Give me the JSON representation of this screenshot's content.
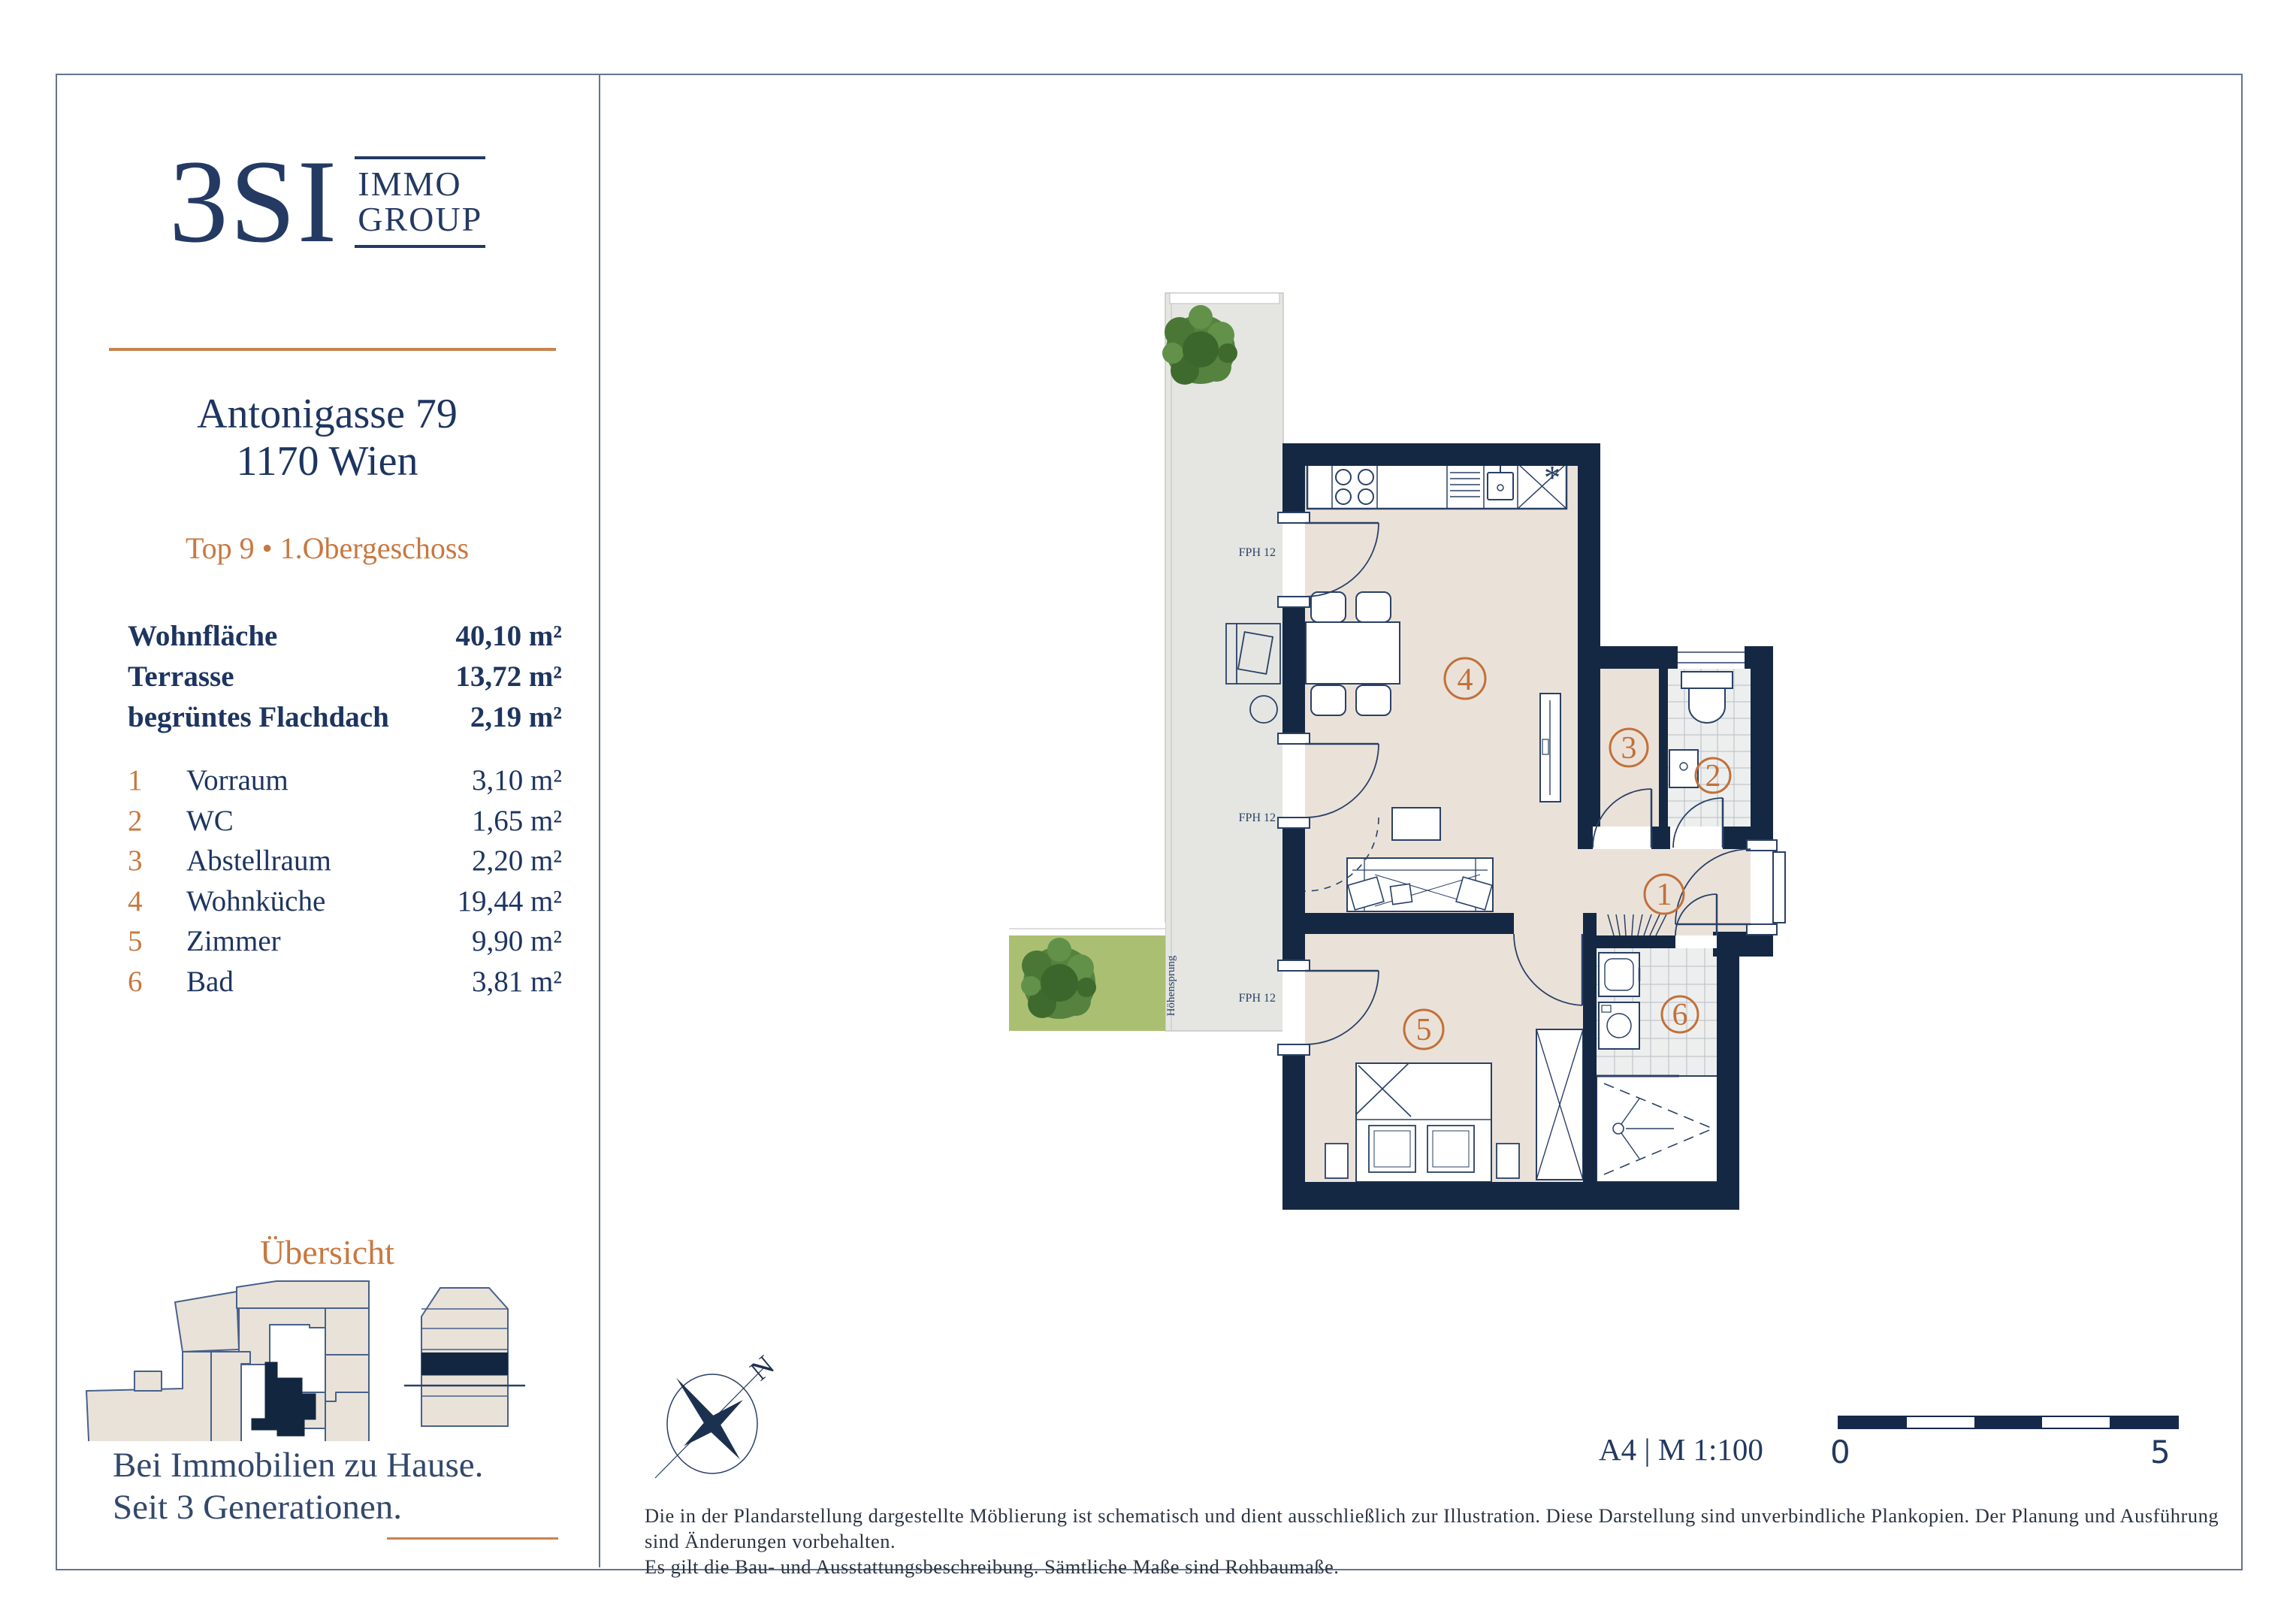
{
  "brand": {
    "logo_text": "3SI",
    "logo_sub_line1": "IMMO",
    "logo_sub_line2": "GROUP"
  },
  "sidebar": {
    "address_line1": "Antonigasse 79",
    "address_line2": "1170 Wien",
    "unit_line": "Top 9 • 1.Obergeschoss",
    "summary": [
      {
        "label": "Wohnfläche",
        "value": "40,10 m²"
      },
      {
        "label": "Terrasse",
        "value": "13,72 m²"
      },
      {
        "label": "begrüntes Flachdach",
        "value": "2,19 m²"
      }
    ],
    "rooms": [
      {
        "num": "1",
        "name": "Vorraum",
        "value": "3,10 m²"
      },
      {
        "num": "2",
        "name": "WC",
        "value": "1,65 m²"
      },
      {
        "num": "3",
        "name": "Abstellraum",
        "value": "2,20 m²"
      },
      {
        "num": "4",
        "name": "Wohnküche",
        "value": "19,44 m²"
      },
      {
        "num": "5",
        "name": "Zimmer",
        "value": "9,90 m²"
      },
      {
        "num": "6",
        "name": "Bad",
        "value": "3,81 m²"
      }
    ],
    "overview_title": "Übersicht",
    "tagline_line1": "Bei Immobilien zu Hause.",
    "tagline_line2": "Seit 3 Generationen."
  },
  "plan": {
    "room_numbers": [
      "1",
      "2",
      "3",
      "4",
      "5",
      "6"
    ],
    "fph_label": "FPH 12",
    "hoehensprung_label": "Höhensprung",
    "freezer_symbol": "*"
  },
  "compass": {
    "north_label": "N"
  },
  "footer": {
    "format_scale": "A4 | M 1:100",
    "scale_zero": "0",
    "scale_five": "5",
    "disclaimer_line1": "Die in der Plandarstellung dargestellte Möblierung ist schematisch und dient ausschließlich zur Illustration. Diese Darstellung sind unverbindliche Plankopien. Der Planung und Ausführung sind Änderungen vorbehalten.",
    "disclaimer_line2": "Es gilt die Bau- und Ausstattungsbeschreibung. Sämtliche Maße sind Rohbaumaße."
  },
  "colors": {
    "navy_text": "#23395f",
    "wall_navy": "#152843",
    "accent_orange": "#c8783f",
    "rule_orange": "#c8834f",
    "floor_beige": "#eae2d9",
    "terrace_grey": "#e5e6e2",
    "green_roof": "#abbf72",
    "tile_grey": "#edefee",
    "border_grey": "#64748f"
  }
}
